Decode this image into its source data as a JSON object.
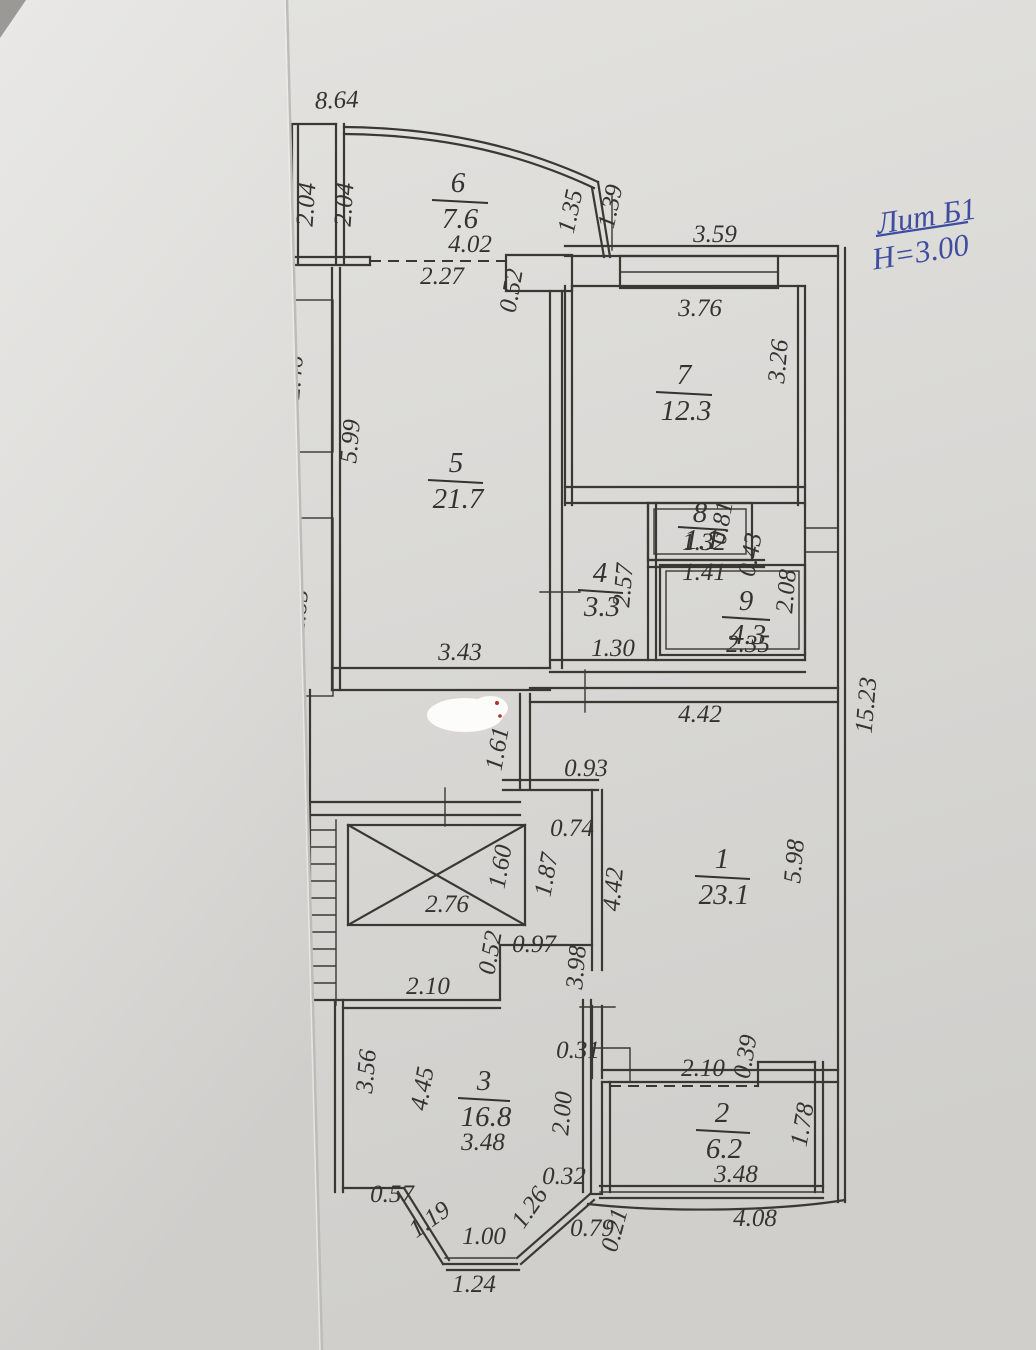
{
  "legend": {
    "liter": "Лит Б1",
    "height": "Н=3.00"
  },
  "rooms": [
    {
      "num": "1",
      "area": "23.1"
    },
    {
      "num": "2",
      "area": "6.2"
    },
    {
      "num": "3",
      "area": "16.8"
    },
    {
      "num": "4",
      "area": "3.3"
    },
    {
      "num": "5",
      "area": "21.7"
    },
    {
      "num": "6",
      "area": "7.6"
    },
    {
      "num": "7",
      "area": "12.3"
    },
    {
      "num": "8",
      "area": "1.1"
    },
    {
      "num": "9",
      "area": "4.3"
    }
  ],
  "dims": {
    "d_8_64": "8.64",
    "d_2_04_a": "2.04",
    "d_2_04_b": "2.04",
    "d_4_02": "4.02",
    "d_2_27": "2.27",
    "d_0_52_top": "0.52",
    "d_1_35": "1.35",
    "d_1_39": "1.39",
    "d_3_59": "3.59",
    "d_3_76": "3.76",
    "d_3_26": "3.26",
    "d_2_46": "2.46",
    "d_2_85": "2.85",
    "d_5_99": "5.99",
    "d_3_43": "3.43",
    "d_2_57": "2.57",
    "d_1_30": "1.30",
    "d_1_32": "1.32",
    "d_0_81": "0.81",
    "d_1_41": "1.41",
    "d_0_43": "0.43",
    "d_2_35": "2.35",
    "d_2_08": "2.08",
    "d_15_23": "15.23",
    "d_4_42_top": "4.42",
    "d_1_61": "1.61",
    "d_0_93": "0.93",
    "d_0_74": "0.74",
    "d_1_87": "1.87",
    "d_1_60": "1.60",
    "d_2_76": "2.76",
    "d_4_42_left": "4.42",
    "d_5_98": "5.98",
    "d_0_52_mid": "0.52",
    "d_0_97": "0.97",
    "d_2_10_mid": "2.10",
    "d_3_98": "3.98",
    "d_0_31": "0.31",
    "d_3_56": "3.56",
    "d_4_45": "4.45",
    "d_3_48_a": "3.48",
    "d_2_00": "2.00",
    "d_0_57": "0.57",
    "d_1_19": "1.19",
    "d_1_00": "1.00",
    "d_1_24": "1.24",
    "d_1_26": "1.26",
    "d_0_32": "0.32",
    "d_0_79": "0.79",
    "d_0_21": "0.21",
    "d_2_10_b": "2.10",
    "d_0_39": "0.39",
    "d_1_78": "1.78",
    "d_3_48_b": "3.48",
    "d_4_08": "4.08"
  }
}
